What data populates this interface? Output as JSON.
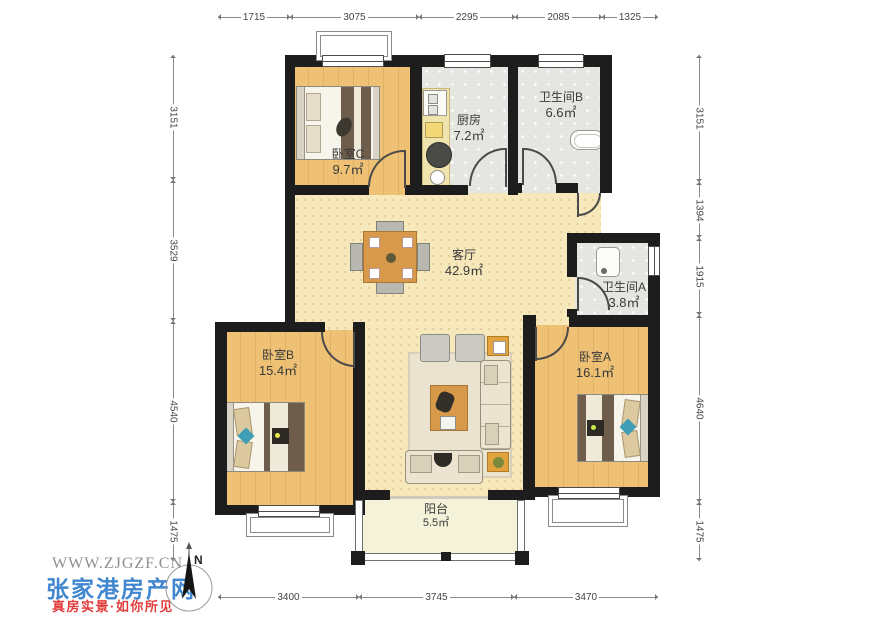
{
  "site": {
    "url": "WWW.ZJGZF.CN",
    "brand": "张家港房产网",
    "slogan": "真房实景·如你所见"
  },
  "compass": {
    "north": "N"
  },
  "rooms": {
    "bedroomC": {
      "name": "卧室C",
      "area": "9.7㎡"
    },
    "kitchen": {
      "name": "厨房",
      "area": "7.2㎡"
    },
    "bathroomB": {
      "name": "卫生间B",
      "area": "6.6㎡"
    },
    "living": {
      "name": "客厅",
      "area": "42.9㎡"
    },
    "bathroomA": {
      "name": "卫生间A",
      "area": "3.8㎡"
    },
    "bedroomB": {
      "name": "卧室B",
      "area": "15.4㎡"
    },
    "bedroomA": {
      "name": "卧室A",
      "area": "16.1㎡"
    },
    "balcony": {
      "name": "阳台",
      "area": "5.5㎡"
    }
  },
  "dims": {
    "top": [
      "1715",
      "3075",
      "2295",
      "2085",
      "1325"
    ],
    "bottom": [
      "3400",
      "3745",
      "3470"
    ],
    "left": [
      "3151",
      "3529",
      "4540",
      "1475"
    ],
    "right": [
      "3151",
      "1394",
      "1915",
      "4640",
      "1475"
    ]
  }
}
